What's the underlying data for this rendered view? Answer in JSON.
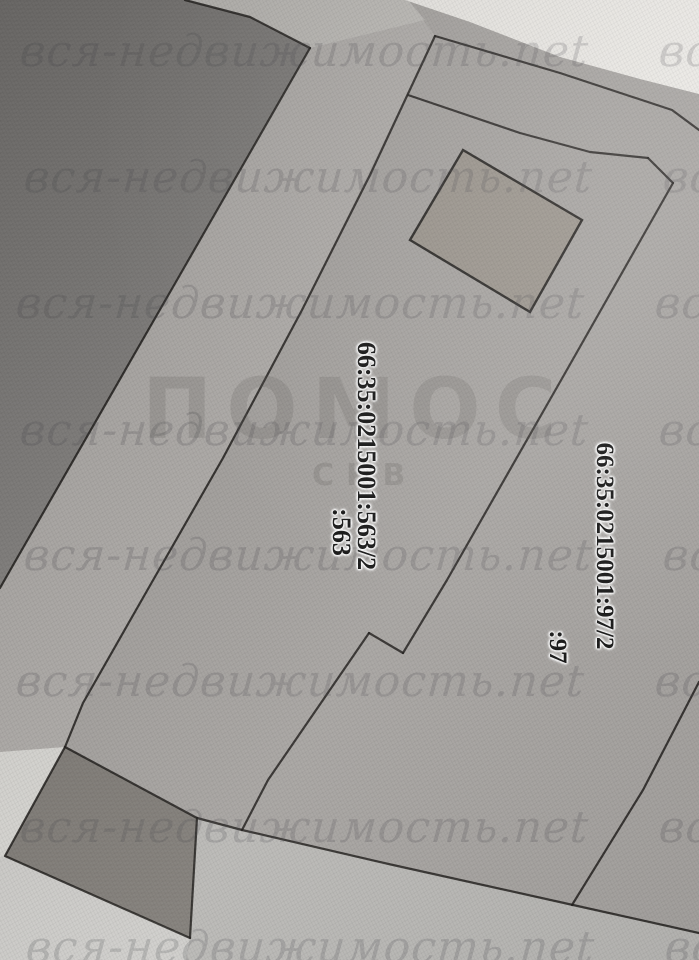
{
  "watermark": {
    "text": "вся-недвижимость.net"
  },
  "logo": {
    "text": "ПОМОС",
    "subtext": "СКВ"
  },
  "parcels": {
    "main": {
      "number": "66:35:0215001:563/2",
      "short": ":563"
    },
    "east": {
      "number": "66:35:0215001:97/2",
      "short": ":97"
    }
  },
  "colors": {
    "paper": "#a7a4a1",
    "paper_light": "#b1aeab",
    "band_dark": "#8a8886",
    "band_deep": "#767472",
    "quad_dark": "#827e79",
    "road_light": "#bab9b6",
    "below_quad": "#cfcecb",
    "white_edge": "#eceae6",
    "white_left": "#d9d8d4",
    "top_strip": "#c6c5c2",
    "line": "#1e1c1a",
    "building_fill": "#9c968e",
    "label_ink": "#141414",
    "watermark_ink": "#45454a",
    "logo_ink": "#5f5c58"
  }
}
